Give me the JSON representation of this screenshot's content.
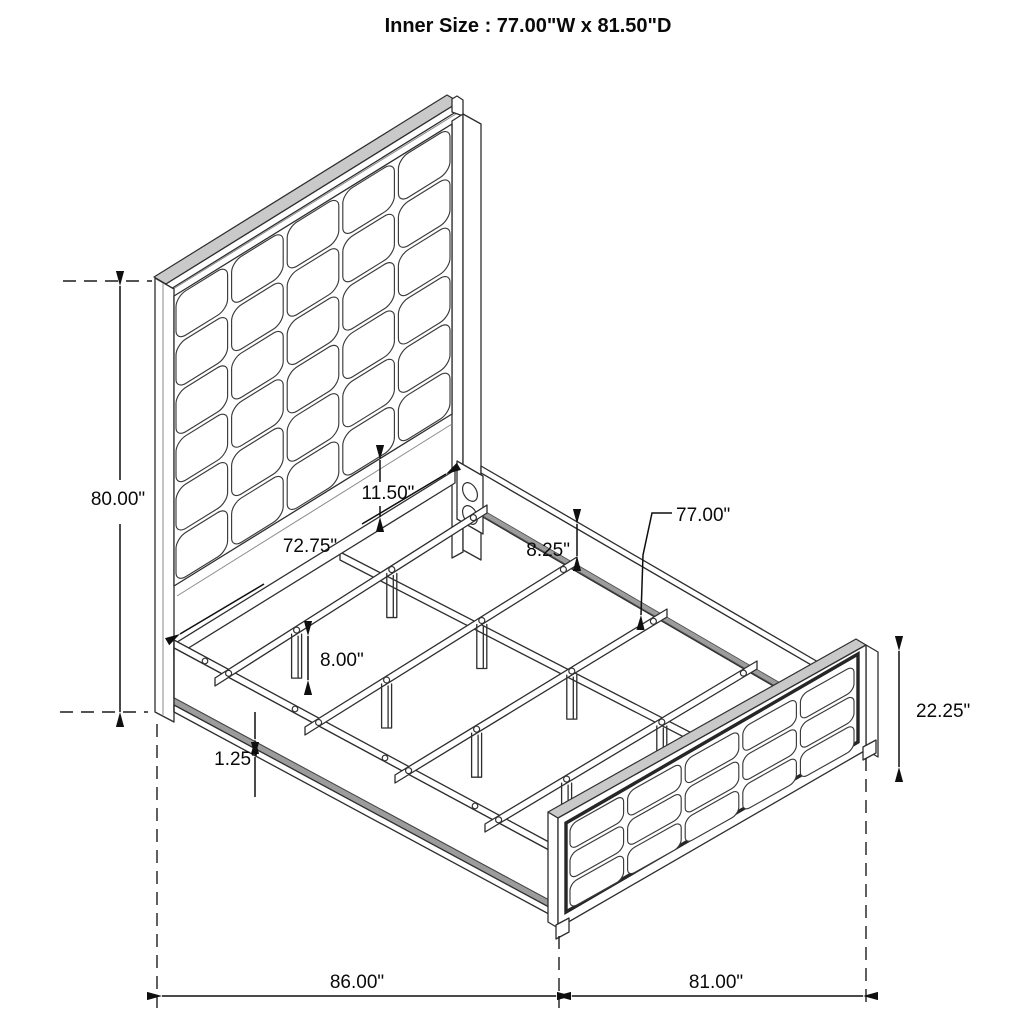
{
  "title": "Inner Size : 77.00\"W x 81.50\"D",
  "dims": {
    "headboard_height": "80.00\"",
    "panel_to_rail_gap": "11.50\"",
    "headboard_inner_width": "72.75\"",
    "side_rail_height": "8.25\"",
    "slat_length": "77.00\"",
    "support_leg_height": "8.00\"",
    "rail_lip_thickness": "1.25\"",
    "footboard_height": "22.25\"",
    "overall_depth": "86.00\"",
    "overall_width": "81.00\""
  }
}
